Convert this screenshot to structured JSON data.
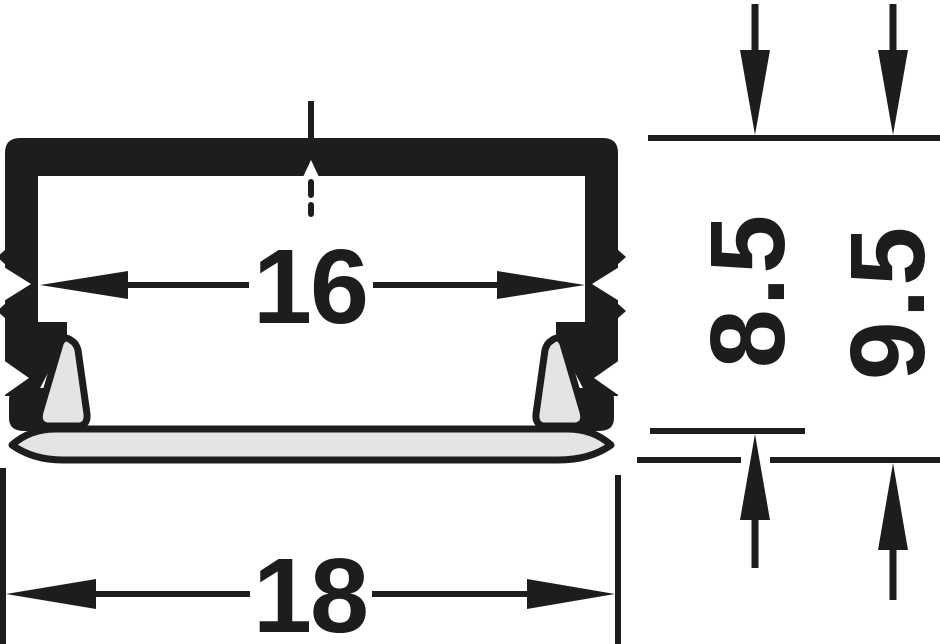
{
  "drawing": {
    "type": "profile-cross-section",
    "colors": {
      "ink": "#1d1d1b",
      "diffuser_fill": "#e3e4e5",
      "background": "#ffffff"
    },
    "dimensions": {
      "inner_width": {
        "label": "16"
      },
      "outer_width": {
        "label": "18"
      },
      "inner_height": {
        "label": "8.5"
      },
      "outer_height": {
        "label": "9.5"
      }
    }
  }
}
